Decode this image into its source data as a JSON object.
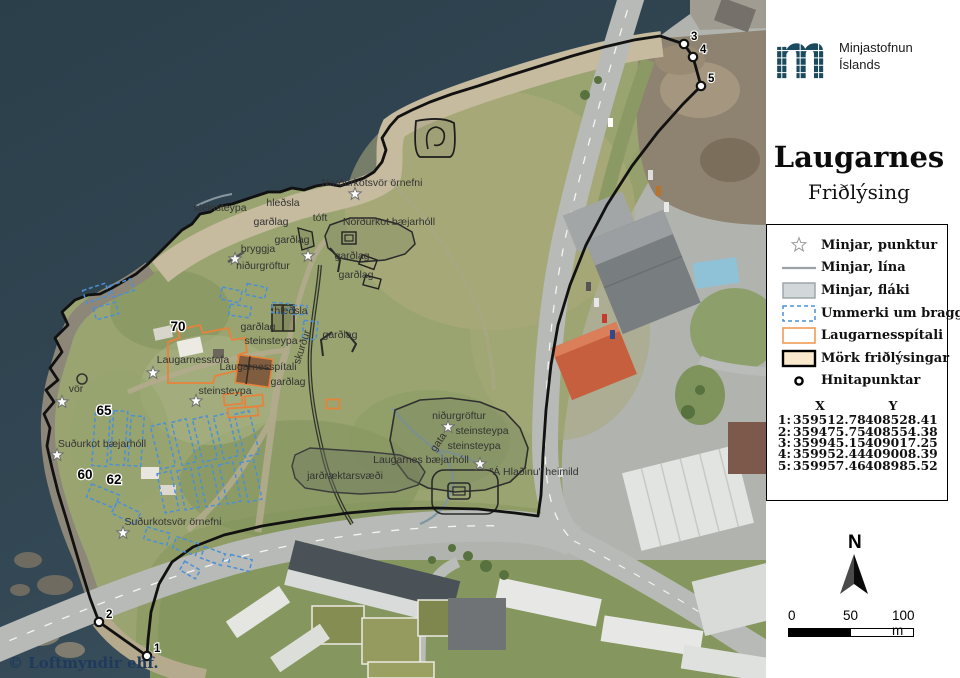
{
  "panel": {
    "logo": {
      "line1": "Minjastofnun",
      "line2": "Íslands"
    },
    "title": "Laugarnes",
    "subtitle": "Friðlýsing",
    "legend": {
      "items": [
        {
          "icon": "star-icon",
          "label": "Minjar, punktur"
        },
        {
          "icon": "line-icon",
          "label": "Minjar, lína"
        },
        {
          "icon": "polygon-icon",
          "label": "Minjar, fláki"
        },
        {
          "icon": "dashed-blue-icon",
          "label": "Ummerki um bragga"
        },
        {
          "icon": "orange-outline-icon",
          "label": "Laugarnesspítali"
        },
        {
          "icon": "boundary-icon",
          "label": "Mörk friðlýsingar"
        },
        {
          "icon": "point-icon",
          "label": "Hnitapunktar"
        }
      ]
    },
    "coordinates": {
      "col_x": "X",
      "col_y": "Y",
      "rows": [
        {
          "n": "1:",
          "x": "359512.78",
          "y": "408528.41"
        },
        {
          "n": "2:",
          "x": "359475.75",
          "y": "408554.38"
        },
        {
          "n": "3:",
          "x": "359945.15",
          "y": "409017.25"
        },
        {
          "n": "4:",
          "x": "359952.44",
          "y": "409008.39"
        },
        {
          "n": "5:",
          "x": "359957.46",
          "y": "408985.52"
        }
      ]
    },
    "north_label": "N",
    "scalebar": {
      "tick0": "0",
      "tick50": "50",
      "tick100": "100 m"
    }
  },
  "map": {
    "copyright": "© Loftmyndir ehf.",
    "labels": [
      {
        "t": "Norðurkotsvör örnefni",
        "x": 372,
        "y": 186
      },
      {
        "t": "hleðsla",
        "x": 283,
        "y": 206
      },
      {
        "t": "steinsteypa",
        "x": 220,
        "y": 211
      },
      {
        "t": "garðlag",
        "x": 271,
        "y": 225
      },
      {
        "t": "tóft",
        "x": 320,
        "y": 221
      },
      {
        "t": "Norðurkot bæjarhóll",
        "x": 389,
        "y": 225
      },
      {
        "t": "garðlag",
        "x": 292,
        "y": 243
      },
      {
        "t": "bryggja",
        "x": 258,
        "y": 252
      },
      {
        "t": "garðlag",
        "x": 352,
        "y": 259
      },
      {
        "t": "niðurgröftur",
        "x": 263,
        "y": 269
      },
      {
        "t": "garðlag",
        "x": 356,
        "y": 278
      },
      {
        "t": "hleðsla",
        "x": 291,
        "y": 314
      },
      {
        "t": "garðlag",
        "x": 258,
        "y": 330
      },
      {
        "t": "garðlag",
        "x": 340,
        "y": 338
      },
      {
        "t": "steinsteypa",
        "x": 271,
        "y": 344
      },
      {
        "t": "skurður",
        "x": 305,
        "y": 348,
        "r": -72
      },
      {
        "t": "Laugarnesstofa",
        "x": 193,
        "y": 363
      },
      {
        "t": "Laugarnesspítali",
        "x": 258,
        "y": 370
      },
      {
        "t": "garðlag",
        "x": 288,
        "y": 385
      },
      {
        "t": "steinsteypa",
        "x": 225,
        "y": 394
      },
      {
        "t": "vör",
        "x": 76,
        "y": 392
      },
      {
        "t": "Suðurkot bæjarhóll",
        "x": 102,
        "y": 447
      },
      {
        "t": "Suðurkotsvör örnefni",
        "x": 173,
        "y": 525
      },
      {
        "t": "niðurgröftur",
        "x": 459,
        "y": 419
      },
      {
        "t": "steinsteypa",
        "x": 482,
        "y": 434
      },
      {
        "t": "steinsteypa",
        "x": 474,
        "y": 449
      },
      {
        "t": "gata",
        "x": 441,
        "y": 444,
        "r": -55
      },
      {
        "t": "Laugarnes bæjarhóll",
        "x": 421,
        "y": 463
      },
      {
        "t": "\"Á Hlaðinu\" heimild",
        "x": 534,
        "y": 475
      },
      {
        "t": "jarðræktarsvæði",
        "x": 345,
        "y": 479
      }
    ],
    "numbers": [
      {
        "t": "70",
        "x": 178,
        "y": 331
      },
      {
        "t": "65",
        "x": 104,
        "y": 415
      },
      {
        "t": "60",
        "x": 85,
        "y": 479
      },
      {
        "t": "62",
        "x": 114,
        "y": 484
      }
    ],
    "stars": [
      [
        355,
        194
      ],
      [
        308,
        256
      ],
      [
        235,
        259
      ],
      [
        153,
        373
      ],
      [
        196,
        401
      ],
      [
        62,
        402
      ],
      [
        57,
        455
      ],
      [
        123,
        533
      ],
      [
        448,
        427
      ],
      [
        480,
        464
      ]
    ],
    "points": [
      {
        "n": "1",
        "x": 147,
        "y": 656
      },
      {
        "n": "2",
        "x": 99,
        "y": 622
      },
      {
        "n": "3",
        "x": 684,
        "y": 44
      },
      {
        "n": "4",
        "x": 693,
        "y": 57
      },
      {
        "n": "5",
        "x": 701,
        "y": 86
      }
    ],
    "bragga": [
      [
        96,
        293,
        24,
        13,
        -18
      ],
      [
        122,
        288,
        22,
        12,
        -18
      ],
      [
        106,
        311,
        23,
        12,
        -15
      ],
      [
        231,
        295,
        20,
        12,
        12
      ],
      [
        256,
        291,
        20,
        11,
        12
      ],
      [
        240,
        311,
        21,
        11,
        8
      ],
      [
        280,
        308,
        16,
        10,
        4
      ],
      [
        300,
        310,
        14,
        9,
        0
      ],
      [
        310,
        330,
        14,
        18,
        6
      ],
      [
        101,
        440,
        15,
        52,
        4
      ],
      [
        119,
        438,
        14,
        54,
        4
      ],
      [
        136,
        441,
        13,
        50,
        4
      ],
      [
        163,
        446,
        15,
        44,
        -14
      ],
      [
        184,
        442,
        15,
        44,
        -14
      ],
      [
        205,
        439,
        15,
        44,
        -14
      ],
      [
        226,
        436,
        15,
        44,
        -14
      ],
      [
        247,
        434,
        15,
        44,
        -14
      ],
      [
        168,
        492,
        14,
        40,
        -12
      ],
      [
        188,
        489,
        14,
        40,
        -12
      ],
      [
        209,
        486,
        14,
        40,
        -12
      ],
      [
        230,
        483,
        14,
        40,
        -12
      ],
      [
        251,
        481,
        14,
        40,
        -12
      ],
      [
        103,
        496,
        30,
        14,
        22
      ],
      [
        126,
        513,
        26,
        13,
        26
      ],
      [
        157,
        536,
        24,
        12,
        16
      ],
      [
        186,
        546,
        24,
        12,
        18
      ],
      [
        213,
        556,
        22,
        12,
        20
      ],
      [
        240,
        563,
        22,
        12,
        14
      ],
      [
        190,
        570,
        18,
        10,
        30
      ]
    ],
    "spitali_rects": [
      [
        233,
        399,
        18,
        11,
        -6
      ],
      [
        254,
        401,
        18,
        11,
        -6
      ],
      [
        243,
        412,
        30,
        9,
        -4
      ],
      [
        333,
        404,
        13,
        9,
        0
      ]
    ],
    "colors": {
      "boundary": "#111111",
      "bragga": "#4a90d9",
      "spitali": "#e8823a"
    }
  }
}
